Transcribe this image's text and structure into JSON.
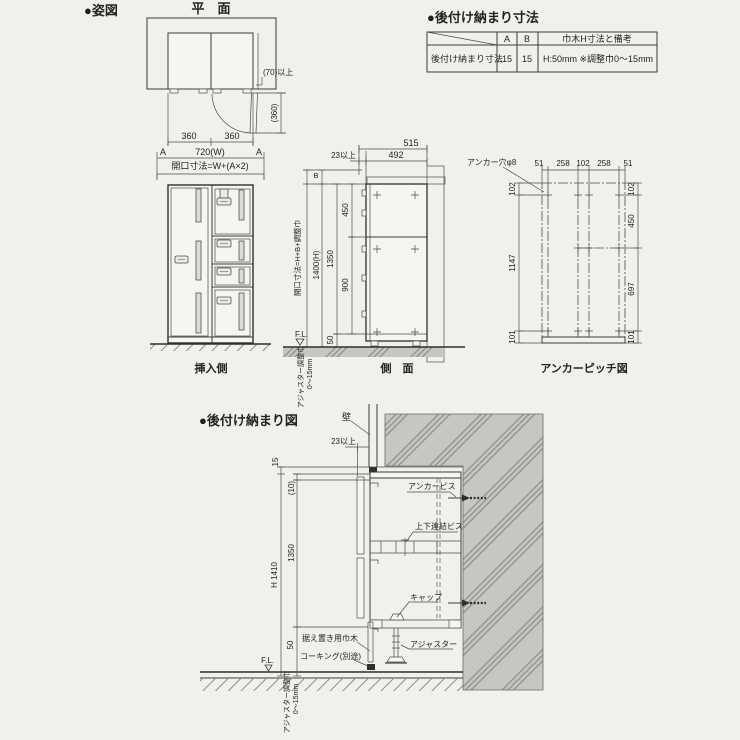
{
  "colors": {
    "background": "#f2f0ea",
    "wall_gray": "#c7c6c3",
    "hatch_line": "#8e8d8a",
    "line": "#3b3b3b"
  },
  "header": {
    "figure_title": "●姿図",
    "plan_label": "平　面",
    "spec_title": "●後付け納まり寸法"
  },
  "spec_table": {
    "col_a": "A",
    "col_b": "B",
    "col_note": "巾木H寸法と備考",
    "row_label": "後付け納まり寸法",
    "val_a": "15",
    "val_b": "15",
    "val_note": "H:50mm ※調整巾0〜15mm"
  },
  "plan": {
    "dim_left_door": "360",
    "dim_right_door": "360",
    "dim_width": "720(W)",
    "a_left": "A",
    "a_right": "A",
    "opening_formula": "開口寸法=W+(A×2)",
    "clearance_side": "(70)以上",
    "door_swing": "(360)"
  },
  "front": {
    "label": "挿入側"
  },
  "side": {
    "label": "側　面",
    "d515": "515",
    "d492": "492",
    "d23": "23以上",
    "b": "B",
    "opening_formula": "開口寸法=H+B+調整巾",
    "d1400": "1400(H)",
    "d1350": "1350",
    "d450": "450",
    "d900": "900",
    "d50": "50",
    "fl": "F.L.",
    "adjuster_note": "アジャスター調整巾",
    "adjuster_range": "0〜15mm"
  },
  "anchor": {
    "label": "アンカーピッチ図",
    "hole_note": "アンカー穴φ8",
    "top_dims": [
      "51",
      "258",
      "102",
      "258",
      "51"
    ],
    "left_dims": [
      "102",
      "1147",
      "101"
    ],
    "right_dims": [
      "102",
      "450",
      "697",
      "101"
    ]
  },
  "detail": {
    "title": "●後付け納まり図",
    "wall": "壁",
    "d23": "23以上",
    "d15": "15",
    "d10": "(10)",
    "d1350": "1350",
    "h_total": "H 1410",
    "d50": "50",
    "fl": "F.L.",
    "anchor_screw": "アンカービス",
    "joint_screw": "上下連結ビス",
    "cap": "キャップ",
    "skirting": "据え置き用巾木",
    "caulking": "コーキング(別途)",
    "adjuster": "アジャスター",
    "adjuster_note": "アジャスター調整巾",
    "adjuster_range": "0〜15mm"
  }
}
